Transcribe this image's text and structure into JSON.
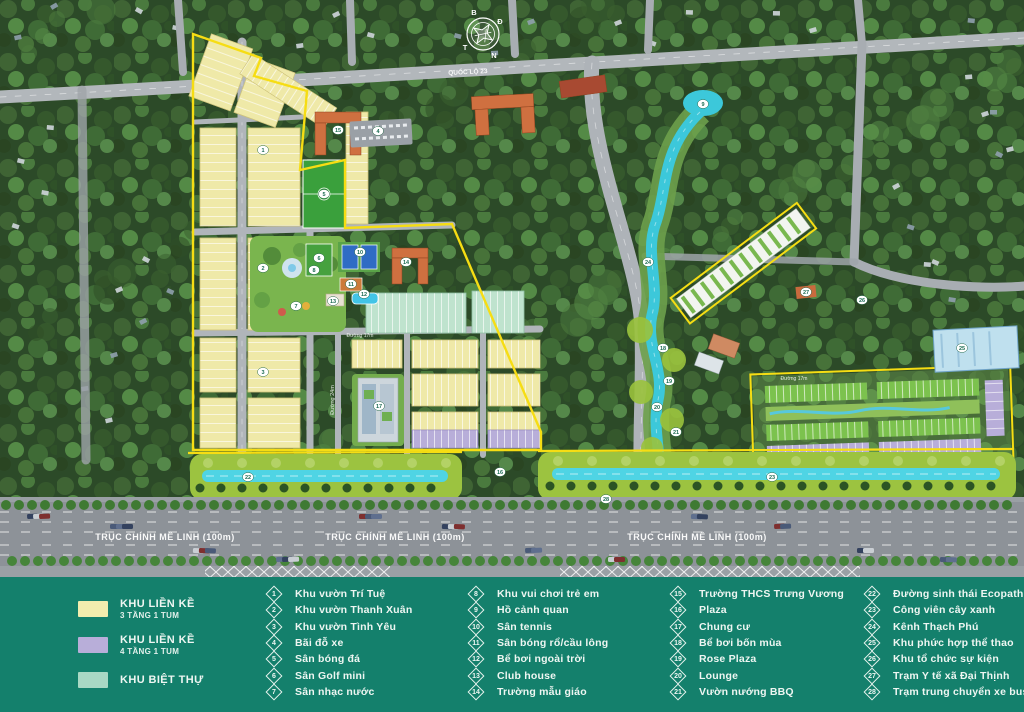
{
  "map": {
    "compass": {
      "n": "B",
      "e": "Đ",
      "s": "N",
      "w": "T"
    },
    "road_labels": {
      "main_axis": "TRỤC CHÍNH MÊ LINH (100m)",
      "highway_23": "QUỐC LỘ 23",
      "road_24m": "Đường 24m",
      "road_17m": "Đường 17m"
    },
    "markers": [
      {
        "n": "1",
        "x": 263,
        "y": 150
      },
      {
        "n": "2",
        "x": 263,
        "y": 268
      },
      {
        "n": "3",
        "x": 263,
        "y": 372
      },
      {
        "n": "4",
        "x": 378,
        "y": 131
      },
      {
        "n": "5",
        "x": 324,
        "y": 194
      },
      {
        "n": "6",
        "x": 319,
        "y": 258
      },
      {
        "n": "7",
        "x": 296,
        "y": 306
      },
      {
        "n": "8",
        "x": 314,
        "y": 270
      },
      {
        "n": "9",
        "x": 703,
        "y": 104
      },
      {
        "n": "10",
        "x": 360,
        "y": 252
      },
      {
        "n": "11",
        "x": 351,
        "y": 284
      },
      {
        "n": "12",
        "x": 364,
        "y": 294
      },
      {
        "n": "13",
        "x": 333,
        "y": 301
      },
      {
        "n": "14",
        "x": 406,
        "y": 262
      },
      {
        "n": "15",
        "x": 338,
        "y": 130
      },
      {
        "n": "16",
        "x": 500,
        "y": 472
      },
      {
        "n": "17",
        "x": 379,
        "y": 406
      },
      {
        "n": "18",
        "x": 663,
        "y": 348
      },
      {
        "n": "19",
        "x": 669,
        "y": 381
      },
      {
        "n": "20",
        "x": 657,
        "y": 407
      },
      {
        "n": "21",
        "x": 676,
        "y": 432
      },
      {
        "n": "22",
        "x": 248,
        "y": 477
      },
      {
        "n": "23",
        "x": 772,
        "y": 477
      },
      {
        "n": "24",
        "x": 648,
        "y": 262
      },
      {
        "n": "25",
        "x": 962,
        "y": 348
      },
      {
        "n": "26",
        "x": 862,
        "y": 300
      },
      {
        "n": "27",
        "x": 806,
        "y": 292
      },
      {
        "n": "28",
        "x": 606,
        "y": 499
      }
    ]
  },
  "legend": {
    "swatches": [
      {
        "color": "#f2edae",
        "line1": "KHU LIỀN KỀ",
        "line2": "3 TẦNG 1 TUM"
      },
      {
        "color": "#b8aed9",
        "line1": "KHU LIỀN KỀ",
        "line2": "4 TẦNG 1 TUM"
      },
      {
        "color": "#a9d8c4",
        "line1": "KHU BIỆT THỰ",
        "line2": ""
      }
    ],
    "items": [
      {
        "num": "1",
        "label": "Khu vườn Trí Tuệ"
      },
      {
        "num": "2",
        "label": "Khu vườn Thanh Xuân"
      },
      {
        "num": "3",
        "label": "Khu vườn Tình Yêu"
      },
      {
        "num": "4",
        "label": "Bãi đỗ xe"
      },
      {
        "num": "5",
        "label": "Sân bóng đá"
      },
      {
        "num": "6",
        "label": "Sân Golf mini"
      },
      {
        "num": "7",
        "label": "Sân nhạc nước"
      },
      {
        "num": "8",
        "label": "Khu vui chơi trẻ em"
      },
      {
        "num": "9",
        "label": "Hồ cảnh quan"
      },
      {
        "num": "10",
        "label": "Sân tennis"
      },
      {
        "num": "11",
        "label": "Sân bóng rổ/cầu lông"
      },
      {
        "num": "12",
        "label": "Bể bơi ngoài trời"
      },
      {
        "num": "13",
        "label": "Club house"
      },
      {
        "num": "14",
        "label": "Trường mẫu giáo"
      },
      {
        "num": "15",
        "label": "Trường THCS Trưng Vương"
      },
      {
        "num": "16",
        "label": "Plaza"
      },
      {
        "num": "17",
        "label": "Chung cư"
      },
      {
        "num": "18",
        "label": "Bể bơi bốn mùa"
      },
      {
        "num": "19",
        "label": "Rose Plaza"
      },
      {
        "num": "20",
        "label": "Lounge"
      },
      {
        "num": "21",
        "label": "Vườn nướng BBQ"
      },
      {
        "num": "22",
        "label": "Đường sinh thái Ecopath"
      },
      {
        "num": "23",
        "label": "Công viên cây xanh"
      },
      {
        "num": "24",
        "label": "Kênh Thạch Phú"
      },
      {
        "num": "25",
        "label": "Khu phức hợp thể thao"
      },
      {
        "num": "26",
        "label": "Khu tổ chức sự kiện"
      },
      {
        "num": "27",
        "label": "Trạm Y tế xã Đại Thịnh"
      },
      {
        "num": "28",
        "label": "Trạm trung chuyển xe bus"
      }
    ]
  }
}
